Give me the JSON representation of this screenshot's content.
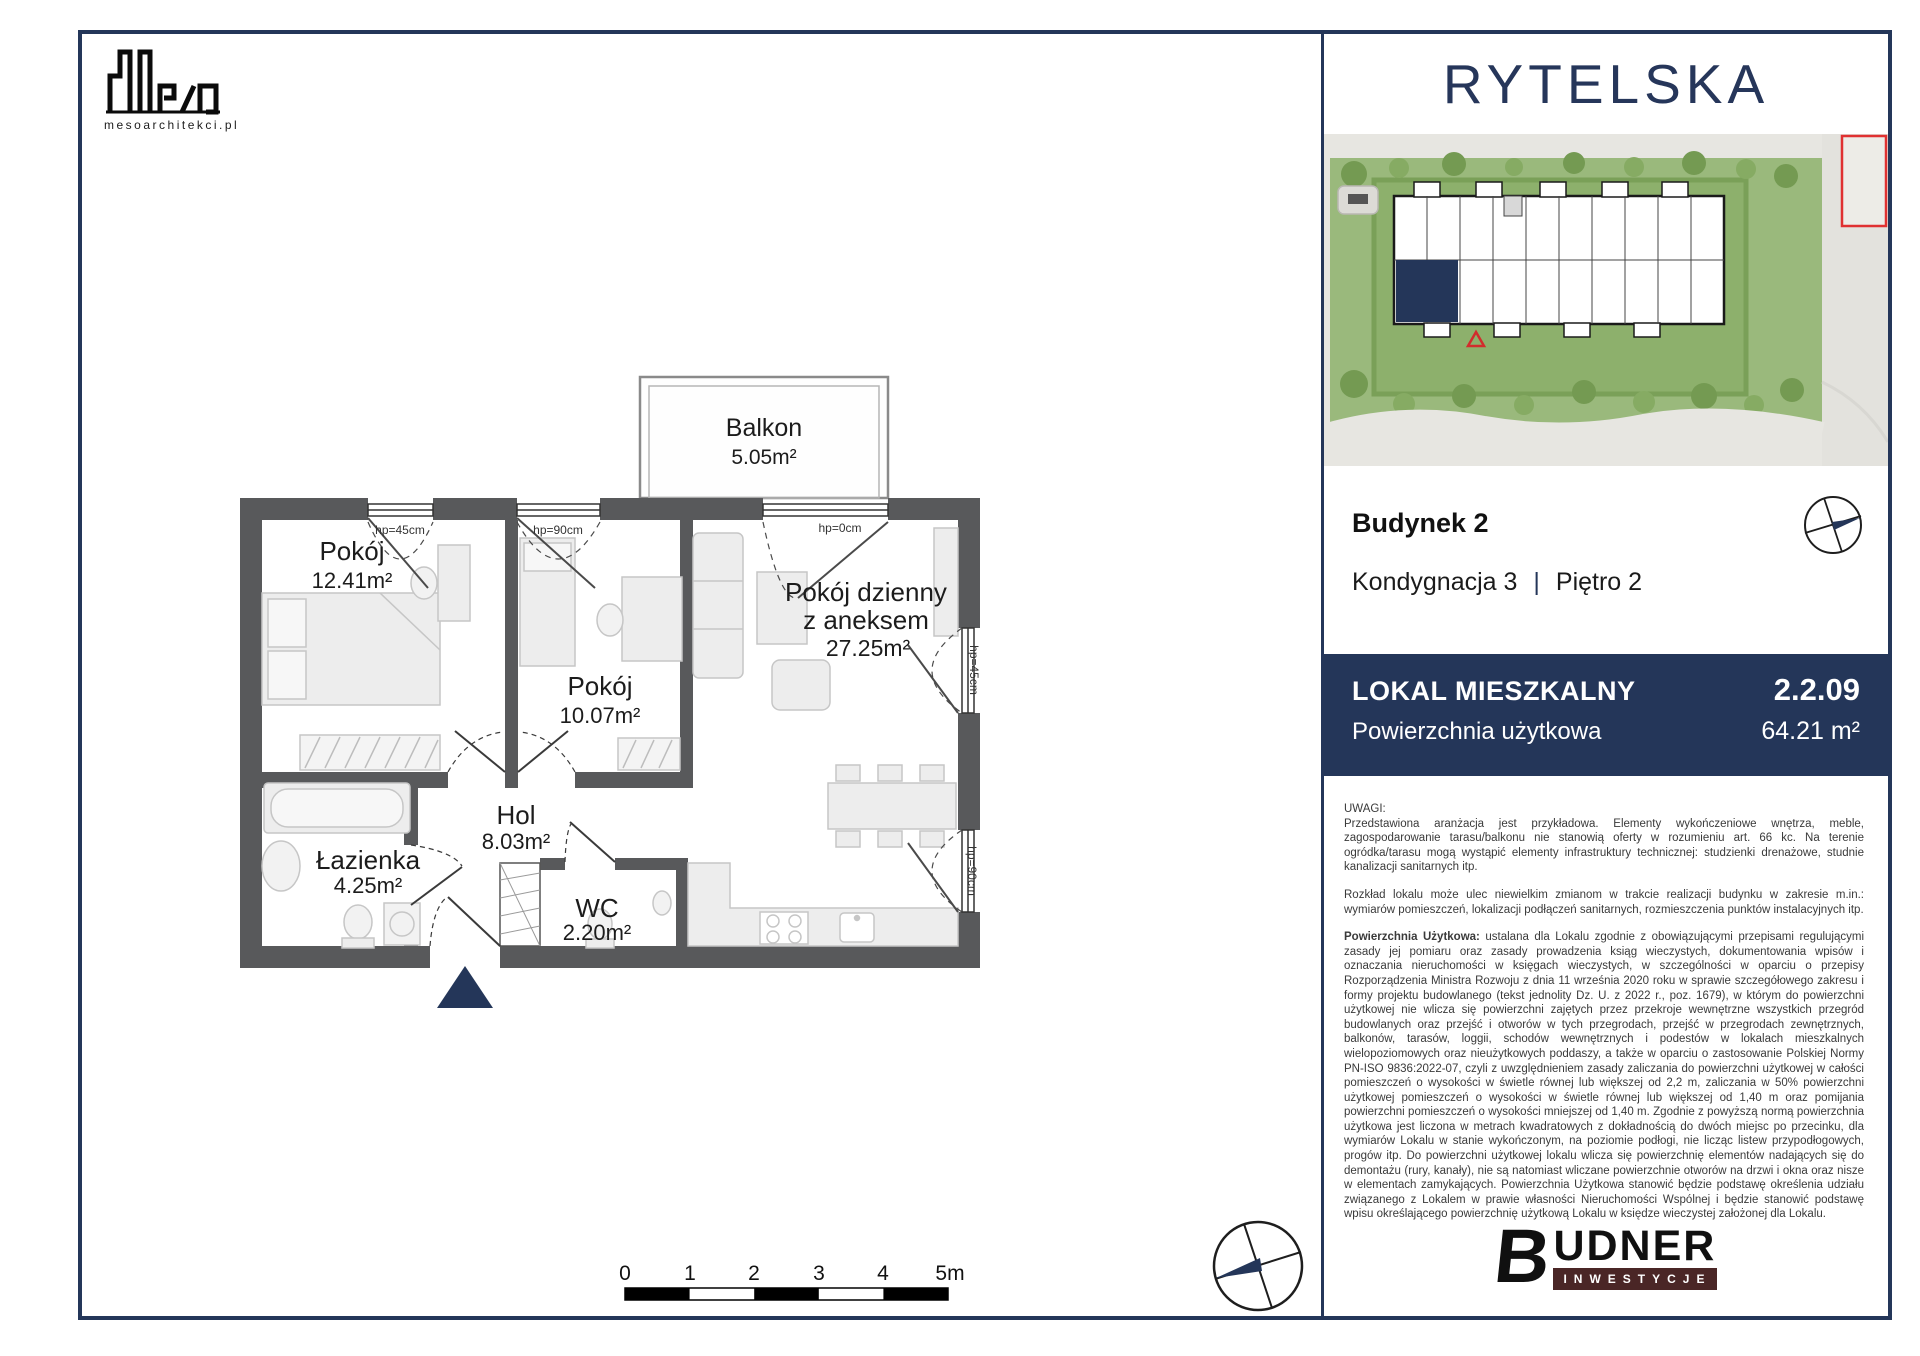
{
  "architect": {
    "website": "mesoarchitekci.pl"
  },
  "brand": {
    "name": "RYTELSKA",
    "navy": "#243659"
  },
  "unit": {
    "building_label": "Budynek 2",
    "storey_label": "Kondygnacja 3",
    "pipe": "|",
    "floor_label": "Piętro 2",
    "type_label": "LOKAL MIESZKALNY",
    "number": "2.2.09",
    "area_label": "Powierzchnia użytkowa",
    "area_value": "64.21 m²"
  },
  "floorplan": {
    "rooms": [
      {
        "name": "Pokój",
        "area": "12.41m²"
      },
      {
        "name": "Pokój",
        "area": "10.07m²"
      },
      {
        "name": "Pokój dzienny",
        "name2": "z aneksem",
        "area": "27.25m²"
      },
      {
        "name": "Hol",
        "area": "8.03m²"
      },
      {
        "name": "Łazienka",
        "area": "4.25m²"
      },
      {
        "name": "WC",
        "area": "2.20m²"
      },
      {
        "name": "Balkon",
        "area": "5.05m²"
      }
    ],
    "window_labels": [
      "hp=45cm",
      "hp=90cm",
      "hp=0cm",
      "hp=45cm",
      "hp=90cm"
    ],
    "scale_ticks": [
      "0",
      "1",
      "2",
      "3",
      "4",
      "5m"
    ],
    "wall_color": "#58595b",
    "highlight_color": "#243659"
  },
  "notes": {
    "heading": "UWAGI:",
    "p1": "Przedstawiona aranżacja jest przykładowa. Elementy wykończeniowe wnętrza, meble, zagospodarowanie tarasu/balkonu nie stanowią oferty w rozumieniu art. 66 kc. Na terenie ogródka/tarasu mogą wystąpić elementy infrastruktury technicznej: studzienki drenażowe, studnie kanalizacji sanitarnych itp.",
    "p2": "Rozkład lokalu może ulec niewielkim zmianom w trakcie realizacji budynku w zakresie m.in.: wymiarów pomieszczeń, lokalizacji podłączeń sanitarnych, rozmieszczenia punktów instalacyjnych itp.",
    "p3_lead": "Powierzchnia Użytkowa:",
    "p3_body": "ustalana dla Lokalu zgodnie z obowiązującymi przepisami regulującymi zasady jej pomiaru oraz zasady prowadzenia ksiąg wieczystych, dokumentowania wpisów i oznaczania nieruchomości w księgach wieczystych, w szczególności w oparciu o przepisy Rozporządzenia Ministra Rozwoju z dnia 11 września 2020 roku w sprawie szczegółowego zakresu i formy projektu budowlanego (tekst jednolity Dz. U. z 2022 r., poz. 1679), w którym do powierzchni użytkowej nie wlicza się powierzchni zajętych przez przekroje wewnętrzne wszystkich przegród budowlanych oraz przejść i otworów w tych przegrodach, przejść w przegrodach zewnętrznych, balkonów, tarasów, loggii, schodów wewnętrznych i podestów w lokalach mieszkalnych wielopoziomowych oraz nieużytkowych poddaszy, a także w oparciu o zastosowanie Polskiej Normy PN-ISO 9836:2022-07, czyli z uwzględnieniem zasady zaliczania do powierzchni użytkowej w całości pomieszczeń o wysokości w świetle równej lub większej od 2,2 m, zaliczania w 50% powierzchni użytkowej pomieszczeń o wysokości w świetle równej lub większej od 1,40 m oraz pomijania powierzchni pomieszczeń o wysokości mniejszej od 1,40 m. Zgodnie z powyższą normą powierzchnia użytkowa jest liczona w metrach kwadratowych z dokładnością do dwóch miejsc po przecinku, dla wymiarów Lokalu w stanie wykończonym, na poziomie podłogi, nie licząc listew przypodłogowych, progów itp. Do powierzchni użytkowej lokalu wlicza się powierzchnię elementów nadających się do demontażu (rury, kanały), nie są natomiast wliczane powierzchnie otworów na drzwi i okna oraz nisze w elementach zamykających. Powierzchnia Użytkowa stanowić będzie podstawę określenia udziału związanego z Lokalem w prawie własności Nieruchomości Wspólnej i będzie stanowić podstawę wpisu określającego powierzchnię użytkową Lokalu w księdze wieczystej założonej dla Lokalu."
  },
  "developer": {
    "b": "B",
    "rest": "UDNER",
    "sub": "INWESTYCJE",
    "bar_color": "#4a2626"
  }
}
